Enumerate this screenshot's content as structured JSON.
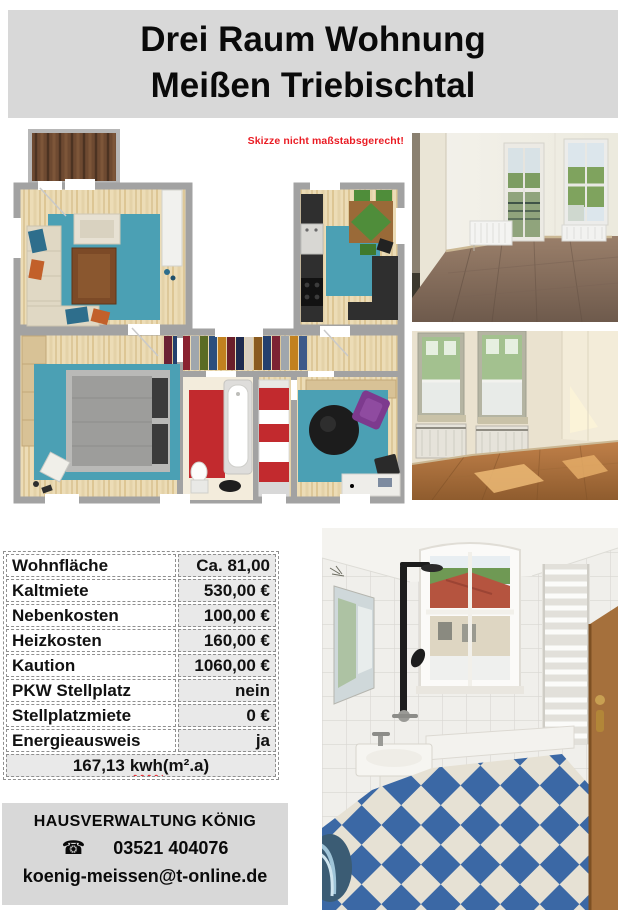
{
  "header": {
    "title_line1": "Drei Raum Wohnung",
    "title_line2": "Meißen Triebischtal"
  },
  "floorplan": {
    "note": "Skizze nicht maßstabsgerecht!"
  },
  "details_table": {
    "rows": [
      {
        "label": "Wohnfläche",
        "value": "Ca. 81,00"
      },
      {
        "label": "Kaltmiete",
        "value": "530,00 €"
      },
      {
        "label": "Nebenkosten",
        "value": "100,00 €"
      },
      {
        "label": "Heizkosten",
        "value": "160,00 €"
      },
      {
        "label": "Kaution",
        "value": "1060,00 €"
      },
      {
        "label": "PKW Stellplatz",
        "value": "nein"
      },
      {
        "label": "Stellplatzmiete",
        "value": "0 €"
      },
      {
        "label": "Energieausweis",
        "value": "ja"
      }
    ],
    "energy_value": "167,13",
    "energy_unit_word": "kwh",
    "energy_unit_rest": "(m².a)"
  },
  "contact": {
    "company": "HAUSVERWALTUNG KÖNIG",
    "phone_icon": "☎",
    "phone": "03521 404076",
    "email": "koenig-meissen@t-online.de"
  },
  "colors": {
    "header_bg": "#d8d8d8",
    "table_value_bg": "#e9e9e9",
    "note_red": "#ea1c24",
    "rug_teal": "#4ba0b4",
    "bath_floor_blue": "#3b68a5"
  }
}
